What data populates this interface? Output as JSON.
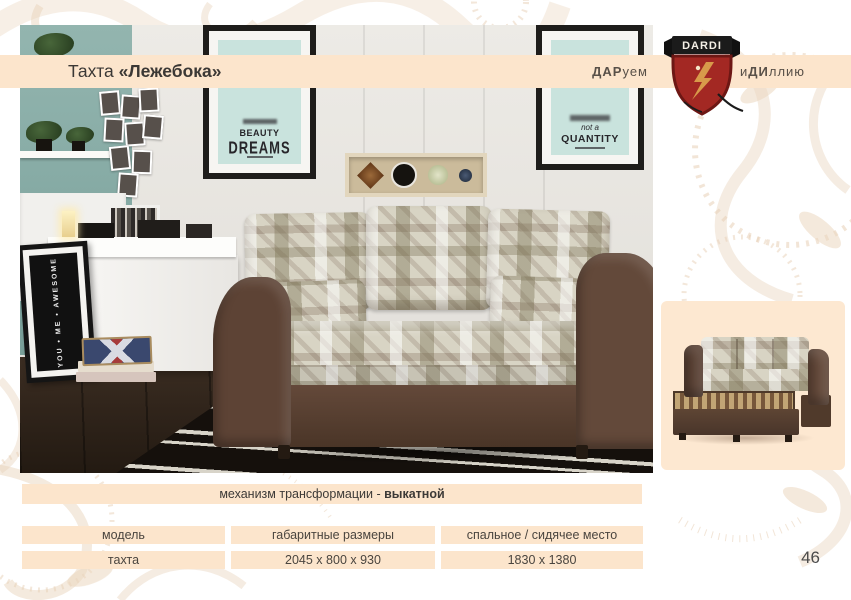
{
  "title": {
    "prefix": "Тахта ",
    "name": "«Лежебока»"
  },
  "brand": {
    "name": "DARDI",
    "tagline_left_bold": "ДАР",
    "tagline_left_rest": "уем",
    "tagline_right_pre": "и",
    "tagline_right_bold": "ДИ",
    "tagline_right_rest": "ллию"
  },
  "room_photo": {
    "poster_beauty_word1": "BEAUTY",
    "poster_beauty_word2": "DREAMS",
    "poster_quantity_script": "not a",
    "poster_quantity_word": "QUANTITY",
    "leaning_frame_words": "YOU • ME • AWESOME"
  },
  "mechanism": {
    "label": "механизм трансформации - ",
    "value": "выкатной"
  },
  "specs": {
    "headers": [
      "модель",
      "габаритные размеры",
      "спальное / сидячее место"
    ],
    "row": [
      "тахта",
      "2045 x 800 x 930",
      "1830 x 1380"
    ]
  },
  "page_number": "46",
  "colors": {
    "accent_cream": "#fce5cc",
    "brand_red": "#a32823",
    "ornament_tan": "#e7d0b6"
  }
}
